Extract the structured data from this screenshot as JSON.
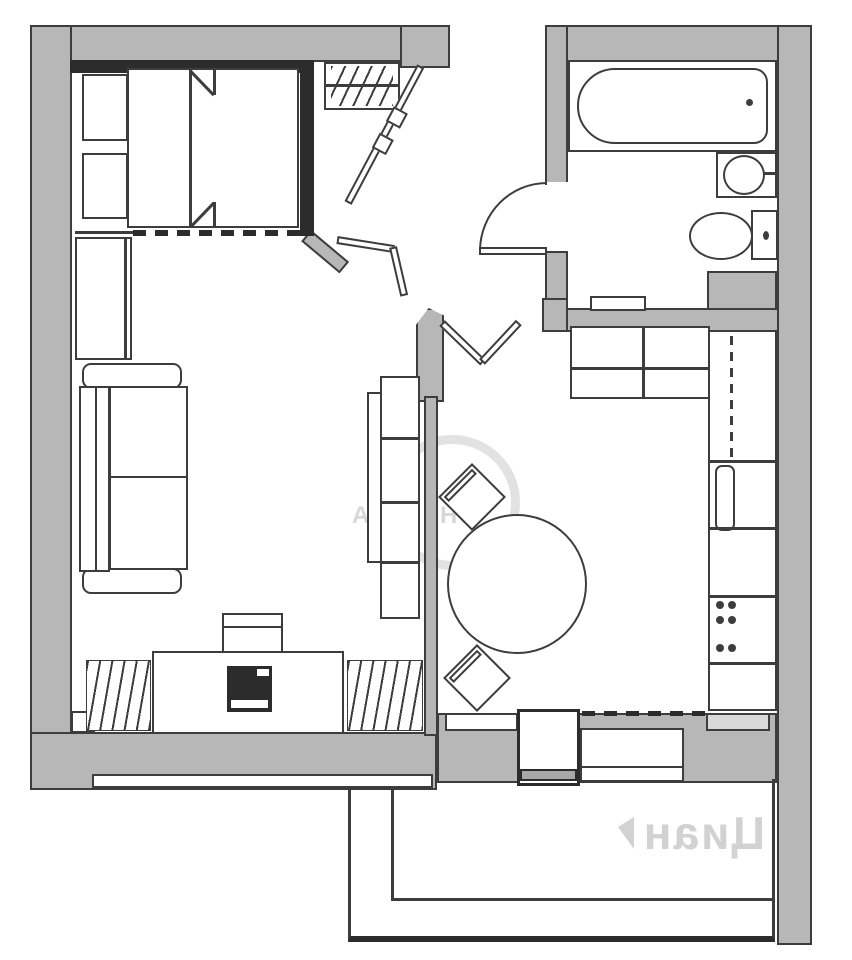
{
  "meta": {
    "type": "apartment-floor-plan",
    "units_labeled": false
  },
  "colors": {
    "wall_fill": "#b7b7b7",
    "line": "#3d3d3d",
    "dark_partition": "#2c2c2c",
    "background": "#ffffff",
    "watermark": "#bdbdbd"
  },
  "wm": {
    "center_left": "АЛ",
    "center_right": "НТ",
    "balcony_text": "Циан",
    "balcony_mirrored": true
  },
  "rooms": [
    {
      "name": "bedroom",
      "position": "top-left"
    },
    {
      "name": "entry-hall",
      "position": "top-center"
    },
    {
      "name": "bathroom",
      "position": "top-right"
    },
    {
      "name": "living-room",
      "position": "left"
    },
    {
      "name": "kitchen-dining",
      "position": "right"
    },
    {
      "name": "balcony",
      "position": "bottom"
    }
  ],
  "fixtures": [
    "double-bed",
    "pillow-fold-marks",
    "nightstand",
    "nightstand",
    "sliding-partition-dashed",
    "hall-closet-with-hangers",
    "entry-door-leaf",
    "bathtub",
    "washbasin",
    "toilet",
    "duct-shaft",
    "bathroom-door-arc",
    "sofa",
    "wardrobe",
    "shelving-unit",
    "tv-stand",
    "tv",
    "shelf",
    "radiator",
    "radiator",
    "window-strip",
    "round-dining-table",
    "chair",
    "chair",
    "kitchen-counter-top",
    "kitchen-counter-right",
    "upper-cabinet-dashed",
    "oven-handle",
    "cooktop-burners",
    "balcony-door",
    "kitchen-window",
    "balcony-slab"
  ]
}
